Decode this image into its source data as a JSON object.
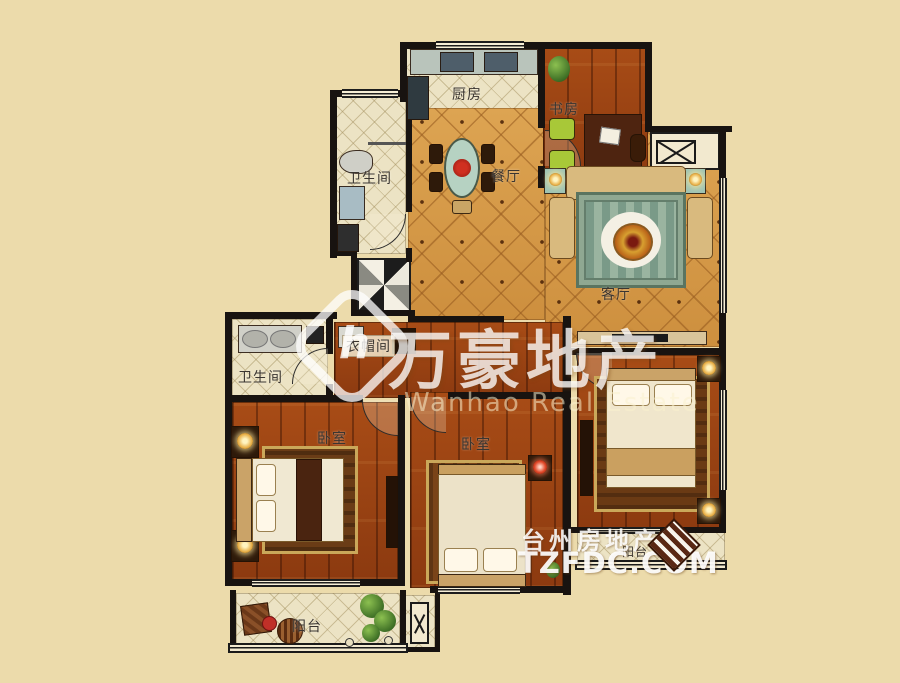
{
  "title": "apartment-floor-plan",
  "colors": {
    "background": "#ecdbab",
    "tile_floor": "#d79a47",
    "wood_floor": "#9c4212",
    "cream_floor": "#ece3c4",
    "wall": "#181310",
    "watermark_white": "#ffffff",
    "site_logo_brown": "#5a2814"
  },
  "rooms": [
    {
      "id": "kitchen",
      "label": "厨房"
    },
    {
      "id": "study",
      "label": "书房"
    },
    {
      "id": "bathroom-upper",
      "label": "卫生间"
    },
    {
      "id": "dining-room",
      "label": "餐厅"
    },
    {
      "id": "living-room",
      "label": "客厅"
    },
    {
      "id": "cloakroom",
      "label": "衣帽间"
    },
    {
      "id": "bathroom-lower",
      "label": "卫生间"
    },
    {
      "id": "bedroom-left",
      "label": "卧室"
    },
    {
      "id": "bedroom-middle",
      "label": "卧室"
    },
    {
      "id": "balcony-right",
      "label": "阳台"
    },
    {
      "id": "balcony-bottom",
      "label": "阳台"
    }
  ],
  "watermark": {
    "logo_letter": "h",
    "brand_cn": "万豪地产",
    "brand_en": "Wanhao Real Estate"
  },
  "site_watermark": {
    "name_cn": "台州房地产网",
    "domain": "TZFDC.COM"
  }
}
